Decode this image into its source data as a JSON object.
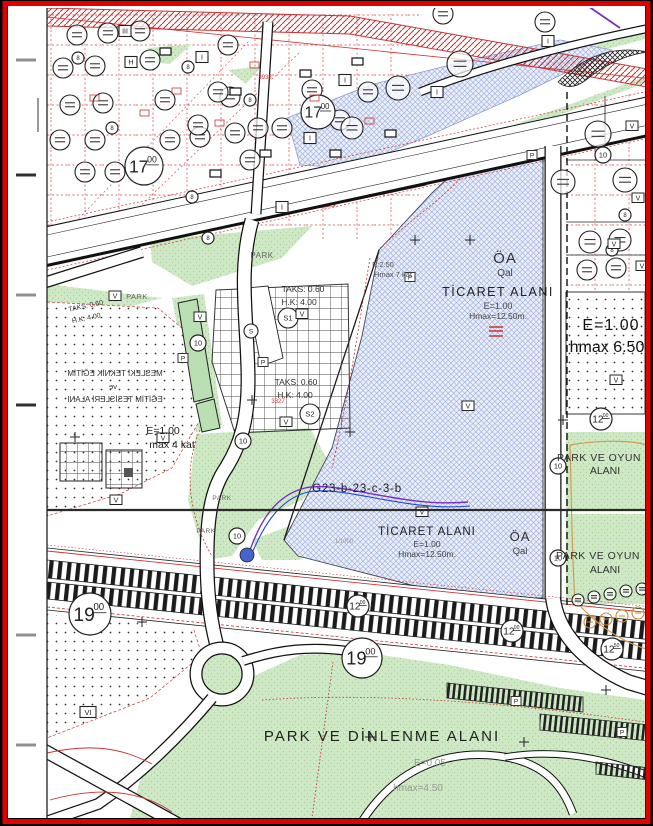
{
  "map": {
    "colors": {
      "border_red": "#e00000",
      "parcel_red": "#cc3333",
      "zone_blue": "#eaeef9",
      "park_green": "#cfe8c5",
      "utility_purple": "#7a2fc0",
      "utility_blue": "#2244dd"
    },
    "zone_labels": {
      "oa1": {
        "abbr": "ÖA",
        "sub": "Qal"
      },
      "oa2": {
        "abbr": "ÖA",
        "sub": "Qal"
      },
      "ticaret1": {
        "name": "TİCARET ALANI",
        "e": "E=1.00",
        "hmax": "Hmax=12.50m."
      },
      "ticaret2": {
        "name": "TİCARET ALANI",
        "e": "E=1.00",
        "hmax": "Hmax=12.50m."
      },
      "egitim": {
        "l1": "MESLEKİ TEKNİK EĞİTİM",
        "l2": "ve",
        "l3": "EĞİTİM TESİSLERİ ALANI",
        "e": "E=1.00",
        "kat": "max 4 kat"
      },
      "right_zone": {
        "e": "E=1.00",
        "hmax": "hmax 6.50"
      },
      "e250": {
        "e": "E:2.50",
        "hmax": "Hmax 7 kat"
      },
      "taks_a": {
        "taks": "TAKS: 0.60",
        "hk": "H.K: 4.00"
      },
      "taks_b": {
        "taks": "TAKS: 0.60",
        "hk": "H.K: 4.00"
      },
      "taks_c": {
        "taks": "TAKS: 0.60",
        "hk": "H.K: 4.00"
      },
      "park_oyun1": {
        "l1": "PARK VE OYUN",
        "l2": "ALANI"
      },
      "park_oyun2": {
        "l1": "PARK VE OYUN",
        "l2": "ALANI"
      },
      "park_dinlenme": {
        "title": "PARK VE DİNLENME ALANI",
        "e": "E=0.05",
        "hmax": "hmax=4.50"
      },
      "sheet": "G23-b-23-c-3-b",
      "scale_note": "1/1000",
      "red_3938": "3938",
      "red_3327": "3327"
    },
    "park_labels": [
      {
        "x": 262,
        "y": 258,
        "t": "PARK",
        "fs": 8
      },
      {
        "x": 137,
        "y": 299,
        "t": "PARK",
        "fs": 7.5
      },
      {
        "x": 222,
        "y": 500,
        "t": "PARK",
        "fs": 6.5
      },
      {
        "x": 206,
        "y": 533,
        "t": "PARK",
        "fs": 6.5
      }
    ],
    "road_circles": [
      {
        "x": 144,
        "y": 166,
        "r": 19,
        "t": "17",
        "s": "00"
      },
      {
        "x": 318,
        "y": 112,
        "r": 17,
        "t": "17",
        "s": "00"
      },
      {
        "x": 90,
        "y": 614,
        "r": 21,
        "t": "19",
        "s": "00"
      },
      {
        "x": 362,
        "y": 658,
        "r": 20,
        "t": "19",
        "s": "00"
      },
      {
        "x": 358,
        "y": 606,
        "r": 11,
        "t": "12",
        "s": "00"
      },
      {
        "x": 512,
        "y": 631,
        "r": 11,
        "t": "12",
        "s": "00"
      },
      {
        "x": 601,
        "y": 419,
        "r": 11,
        "t": "12",
        "s": "00"
      },
      {
        "x": 612,
        "y": 649,
        "r": 11,
        "t": "12",
        "s": "50"
      },
      {
        "x": 198,
        "y": 343,
        "r": 8,
        "t": "10"
      },
      {
        "x": 243,
        "y": 441,
        "r": 8,
        "t": "10"
      },
      {
        "x": 237,
        "y": 536,
        "r": 8,
        "t": "10"
      },
      {
        "x": 558,
        "y": 466,
        "r": 8,
        "t": "10"
      },
      {
        "x": 558,
        "y": 558,
        "r": 8,
        "t": "10"
      },
      {
        "x": 603,
        "y": 155,
        "r": 8,
        "t": "10"
      },
      {
        "x": 78,
        "y": 58,
        "r": 6,
        "t": "8"
      },
      {
        "x": 188,
        "y": 67,
        "r": 6,
        "t": "8"
      },
      {
        "x": 112,
        "y": 128,
        "r": 6,
        "t": "8"
      },
      {
        "x": 250,
        "y": 100,
        "r": 6,
        "t": "8"
      },
      {
        "x": 192,
        "y": 197,
        "r": 6,
        "t": "8"
      },
      {
        "x": 208,
        "y": 238,
        "r": 6,
        "t": "8"
      },
      {
        "x": 625,
        "y": 215,
        "r": 6,
        "t": "8"
      },
      {
        "x": 612,
        "y": 250,
        "r": 6,
        "t": "8"
      }
    ],
    "s_circles": [
      {
        "x": 288,
        "y": 318,
        "r": 10,
        "t": "S1"
      },
      {
        "x": 310,
        "y": 414,
        "r": 10,
        "t": "S2"
      },
      {
        "x": 251,
        "y": 331,
        "r": 7,
        "t": "S"
      }
    ],
    "v_label": "V",
    "p_label": "P",
    "vi_box": {
      "x": 88,
      "y": 712,
      "t": "VI"
    },
    "v_boxes": [
      [
        115,
        296
      ],
      [
        200,
        317
      ],
      [
        302,
        314
      ],
      [
        286,
        422
      ],
      [
        163,
        438
      ],
      [
        116,
        500
      ],
      [
        468,
        406
      ],
      [
        422,
        512
      ],
      [
        632,
        126
      ],
      [
        638,
        198
      ],
      [
        614,
        244
      ],
      [
        642,
        266
      ],
      [
        616,
        380
      ]
    ],
    "p_boxes": [
      [
        183,
        358
      ],
      [
        263,
        362
      ],
      [
        410,
        277
      ],
      [
        532,
        155
      ],
      [
        516,
        701
      ],
      [
        622,
        732
      ]
    ],
    "i_boxes": [
      {
        "x": 125,
        "y": 31,
        "t": "III"
      },
      {
        "x": 202,
        "y": 57,
        "t": "I"
      },
      {
        "x": 131,
        "y": 62,
        "t": "H"
      },
      {
        "x": 345,
        "y": 80,
        "t": "I"
      },
      {
        "x": 437,
        "y": 92,
        "t": "I"
      },
      {
        "x": 548,
        "y": 41,
        "t": "I"
      },
      {
        "x": 310,
        "y": 138,
        "t": "I"
      },
      {
        "x": 282,
        "y": 207,
        "t": "I"
      }
    ],
    "trees": [
      [
        77,
        35
      ],
      [
        108,
        33
      ],
      [
        140,
        31
      ],
      [
        63,
        68
      ],
      [
        95,
        66
      ],
      [
        150,
        60
      ],
      [
        228,
        45
      ],
      [
        70,
        105
      ],
      [
        103,
        103
      ],
      [
        165,
        100
      ],
      [
        230,
        97
      ],
      [
        60,
        140
      ],
      [
        95,
        140
      ],
      [
        170,
        140
      ],
      [
        200,
        137
      ],
      [
        235,
        133
      ],
      [
        85,
        172
      ],
      [
        115,
        172
      ],
      [
        258,
        128
      ],
      [
        218,
        92
      ],
      [
        198,
        125
      ],
      [
        250,
        160
      ],
      [
        282,
        128
      ],
      [
        312,
        90
      ],
      [
        340,
        120
      ],
      [
        368,
        92
      ],
      [
        460,
        64,
        13
      ],
      [
        398,
        88,
        12
      ],
      [
        352,
        128,
        11
      ],
      [
        443,
        14
      ],
      [
        545,
        22
      ],
      [
        598,
        134,
        13
      ],
      [
        563,
        182,
        12
      ],
      [
        625,
        180,
        12
      ],
      [
        590,
        242,
        11
      ],
      [
        620,
        240,
        11
      ],
      [
        587,
        270,
        10
      ],
      [
        616,
        268,
        10
      ],
      [
        578,
        600,
        6
      ],
      [
        594,
        597,
        6
      ],
      [
        610,
        594,
        6
      ],
      [
        626,
        591,
        6
      ],
      [
        642,
        589,
        6
      ]
    ],
    "trees_orange": [
      [
        590,
        622,
        6
      ],
      [
        606,
        619,
        6
      ],
      [
        622,
        616,
        6
      ],
      [
        638,
        613,
        6
      ]
    ],
    "plus_marks": [
      [
        415,
        240
      ],
      [
        350,
        432
      ],
      [
        252,
        400
      ],
      [
        75,
        437
      ],
      [
        370,
        737
      ],
      [
        524,
        742
      ],
      [
        563,
        420
      ],
      [
        142,
        622
      ],
      [
        606,
        690
      ],
      [
        470,
        240
      ]
    ],
    "buildings": [
      [
        160,
        48
      ],
      [
        230,
        88
      ],
      [
        300,
        70
      ],
      [
        352,
        58
      ],
      [
        260,
        150
      ],
      [
        210,
        170
      ],
      [
        330,
        150
      ],
      [
        385,
        130
      ]
    ],
    "red_rects": [
      [
        90,
        95
      ],
      [
        140,
        110
      ],
      [
        250,
        62
      ],
      [
        310,
        95
      ],
      [
        365,
        118
      ],
      [
        215,
        120
      ],
      [
        172,
        88
      ]
    ],
    "left_ticks": [
      {
        "y": 60,
        "c": "#909090"
      },
      {
        "y": 175,
        "c": "#303030"
      },
      {
        "y": 295,
        "c": "#909090"
      },
      {
        "y": 405,
        "c": "#303030"
      },
      {
        "y": 635,
        "c": "#909090"
      },
      {
        "y": 745,
        "c": "#909090"
      }
    ]
  }
}
